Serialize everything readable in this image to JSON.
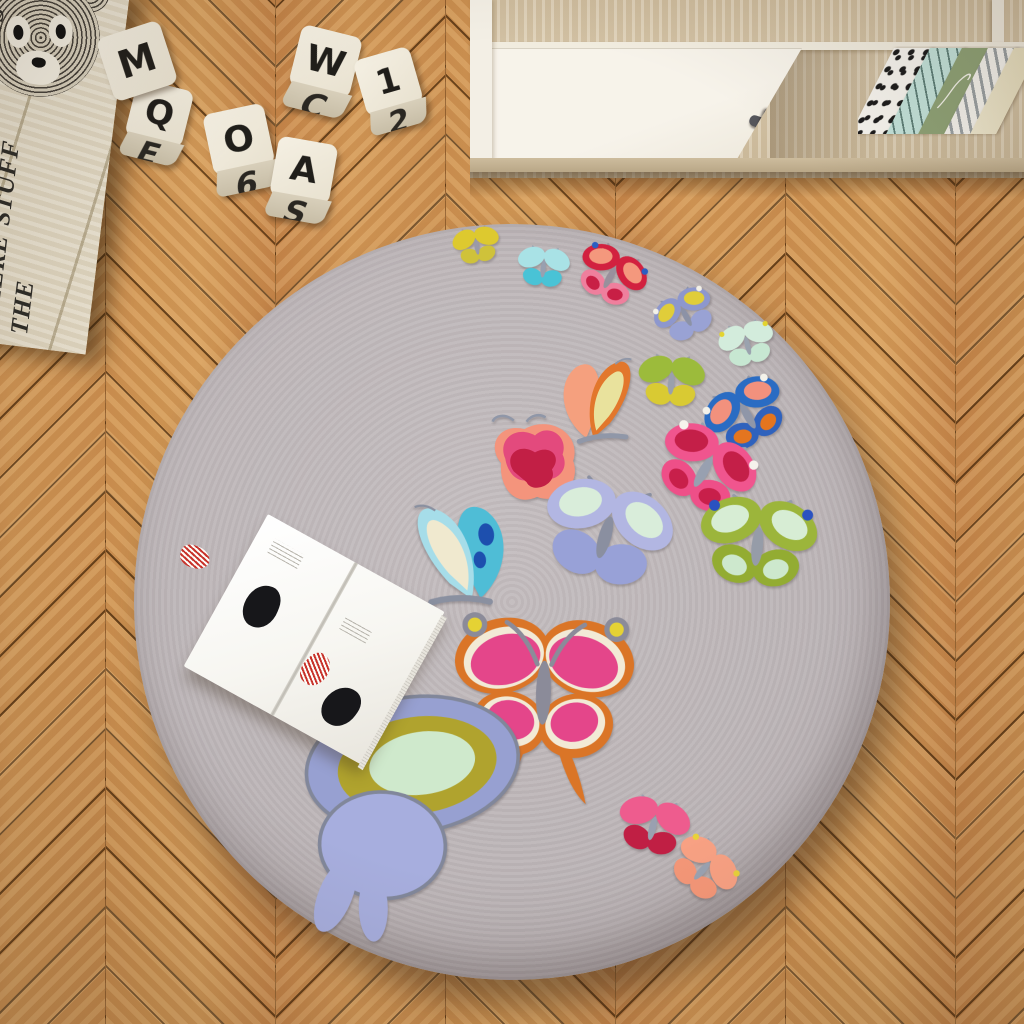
{
  "scene": {
    "title": "Kids room top view: round butterfly rug on herringbone parquet"
  },
  "palette": {
    "floor_wood": "#c88e4e",
    "floor_seam": "#46280c",
    "floor_grain_light": "#e4b877",
    "rug_base": "#bdb6b8",
    "rug_edge": "#a79fa1",
    "cabinet_wood": "#d5c4a6",
    "cabinet_white": "#f4f0e7",
    "knob_gray": "#55555a",
    "crate_wood": "#e6ddc9",
    "crate_print": "#2e2c28",
    "block_face": "#f1ebdd",
    "block_letter": "#201e1a",
    "book_page": "#fbfaf6",
    "book_red": "#c8342c",
    "book_black": "#17171a"
  },
  "crate": {
    "text_lines": [
      "THIS IS WHERE THE",
      "FUN STUFF",
      "HAPPENS"
    ],
    "illustration": "scribbled-teddy-bear-face"
  },
  "blocks": [
    {
      "top": "Q",
      "front": "E",
      "x": 128,
      "y": 84,
      "size": 58,
      "rot": 14
    },
    {
      "top": "M",
      "front": "",
      "x": 104,
      "y": 28,
      "size": 66,
      "rot": -18
    },
    {
      "top": "O",
      "front": "6",
      "x": 210,
      "y": 108,
      "size": 62,
      "rot": -12
    },
    {
      "top": "W",
      "front": "C",
      "x": 292,
      "y": 30,
      "size": 62,
      "rot": 14
    },
    {
      "top": "1",
      "front": "2",
      "x": 362,
      "y": 52,
      "size": 58,
      "rot": -16
    },
    {
      "top": "A",
      "front": "S",
      "x": 272,
      "y": 140,
      "size": 60,
      "rot": 10
    }
  ],
  "cabinet": {
    "books": [
      {
        "name": "polka-dot-book",
        "style": "dots"
      },
      {
        "name": "mint-wave-book",
        "style": "mint"
      },
      {
        "name": "sage-green-book",
        "style": "sage"
      },
      {
        "name": "gray-stripe-book",
        "style": "stripe"
      },
      {
        "name": "cream-book",
        "style": "cream"
      }
    ]
  },
  "rug": {
    "cx": 512,
    "cy": 602,
    "r": 378
  },
  "butterflies": [
    {
      "name": "yellow",
      "style": "classic",
      "x": 450,
      "y": 222,
      "w": 54,
      "h": 52,
      "rot": -10,
      "c": {
        "upper": "#ddc92f",
        "lower": "#cfc23a",
        "body": "#9a9aa8"
      }
    },
    {
      "name": "cyan",
      "style": "classic",
      "x": 512,
      "y": 241,
      "w": 62,
      "h": 58,
      "rot": 6,
      "c": {
        "upper": "#a9e2e6",
        "lower": "#49c3d6",
        "body": "#98a0b0"
      }
    },
    {
      "name": "red-salmon",
      "style": "classic",
      "x": 570,
      "y": 238,
      "w": 78,
      "h": 82,
      "rot": 28,
      "c": {
        "upper": "#d2213f",
        "innerU": "#f4987d",
        "lower": "#ef7f9d",
        "innerL": "#c81f45",
        "accent": "#2b5ec2",
        "body": "#99909c"
      }
    },
    {
      "name": "periwinkle-yellow",
      "style": "classic",
      "x": 640,
      "y": 284,
      "w": 94,
      "h": 68,
      "rot": -28,
      "c": {
        "upper": "#8d97cd",
        "innerU": "#e0cd3a",
        "lower": "#99a2d4",
        "accent": "#f3f1e8",
        "body": "#8c92a6"
      }
    },
    {
      "name": "mint",
      "style": "classic",
      "x": 714,
      "y": 316,
      "w": 68,
      "h": 62,
      "rot": -14,
      "c": {
        "upper": "#d3ecdc",
        "lower": "#c7e7d2",
        "accent": "#e3d42f",
        "body": "#9aa2ae"
      }
    },
    {
      "name": "chartreuse",
      "style": "classic",
      "x": 632,
      "y": 348,
      "w": 78,
      "h": 74,
      "rot": 4,
      "c": {
        "upper": "#9cbb3b",
        "lower": "#d9ca33",
        "body": "#9aa0ac"
      }
    },
    {
      "name": "blue-orange",
      "style": "classic",
      "x": 696,
      "y": 372,
      "w": 106,
      "h": 92,
      "rot": -30,
      "c": {
        "upper": "#2a6cc3",
        "innerU": "#f2917d",
        "lower": "#2f62bd",
        "innerL": "#e4751f",
        "accent": "#f4f2ea",
        "body": "#8f96a8"
      }
    },
    {
      "name": "orange-flight",
      "style": "side",
      "x": 554,
      "y": 350,
      "w": 90,
      "h": 100,
      "rot": 0,
      "c": {
        "back": "#f5a07e",
        "front": "#e2772c",
        "inner": "#e9e29d",
        "body": "#9097a8"
      }
    },
    {
      "name": "rose",
      "style": "rose",
      "x": 476,
      "y": 410,
      "w": 118,
      "h": 106,
      "rot": 0,
      "c": {
        "back": "#f4947c",
        "mid": "#e34a7d",
        "inner": "#c21f45",
        "body": "#9097a8"
      }
    },
    {
      "name": "turquoise-large",
      "style": "side",
      "x": 404,
      "y": 476,
      "w": 112,
      "h": 154,
      "rot": -6,
      "flip": true,
      "c": {
        "back": "#4fbdd6",
        "front": "#a6dde9",
        "inner": "#f0e9cf",
        "accent": "#1d4fae",
        "body": "#8a90a0"
      }
    },
    {
      "name": "lavender-large",
      "style": "classic",
      "x": 530,
      "y": 468,
      "w": 148,
      "h": 144,
      "rot": 16,
      "c": {
        "upper": "#b2b6e2",
        "innerU": "#d9edda",
        "lower": "#98a1d7",
        "body": "#8a8fa0"
      }
    },
    {
      "name": "pink-crimson",
      "style": "classic",
      "x": 646,
      "y": 418,
      "w": 112,
      "h": 112,
      "rot": 30,
      "c": {
        "upper": "#f0558e",
        "innerU": "#c41f48",
        "lower": "#ee4f88",
        "innerL": "#c81f4a",
        "accent": "#f6f3ec",
        "body": "#98a0b0"
      }
    },
    {
      "name": "green-bluedot",
      "style": "classic",
      "x": 692,
      "y": 484,
      "w": 130,
      "h": 130,
      "rot": 6,
      "c": {
        "upper": "#9cb53b",
        "innerU": "#d7edd4",
        "lower": "#93ac32",
        "innerL": "#cde8cd",
        "accent": "#2a52c1",
        "body": "#969ca8"
      }
    },
    {
      "name": "pink-swallowtail",
      "style": "swallow",
      "x": 452,
      "y": 604,
      "w": 182,
      "h": 204,
      "rot": 2,
      "c": {
        "outline": "#da7527",
        "trim": "#f2ead6",
        "wing": "#e4468a",
        "ring": "#8b8b99",
        "accent": "#e5d234",
        "body": "#8b8b99"
      }
    },
    {
      "name": "half-swallowtail",
      "style": "half",
      "x": 264,
      "y": 686,
      "w": 252,
      "h": 242,
      "rot": 4,
      "c": {
        "outer": "#97a0d1",
        "mid": "#b0a32e",
        "inner": "#cfe9cc",
        "lowerWing": "#a7aede",
        "body": "#81879a"
      }
    },
    {
      "name": "small-pink",
      "style": "classic",
      "x": 610,
      "y": 790,
      "w": 84,
      "h": 80,
      "rot": 14,
      "c": {
        "upper": "#ee5c8e",
        "lower": "#c01f44",
        "body": "#9aa0b0"
      }
    },
    {
      "name": "small-salmon",
      "style": "classic",
      "x": 662,
      "y": 834,
      "w": 78,
      "h": 76,
      "rot": 42,
      "c": {
        "upper": "#f8a183",
        "lower": "#f59778",
        "accent": "#e8d23a",
        "body": "#9aa2b2"
      }
    }
  ]
}
